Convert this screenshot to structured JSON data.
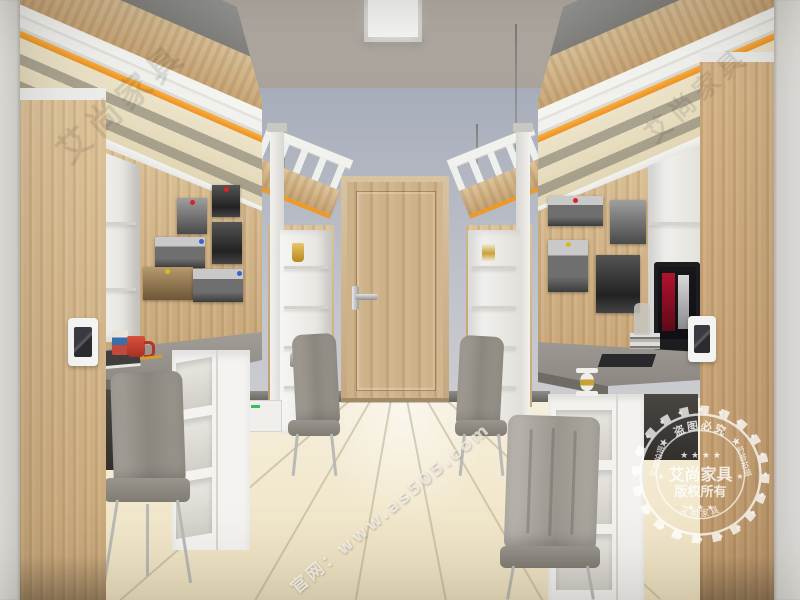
{
  "watermarks": {
    "brand": "艾尚家具",
    "site": "官网：www.as505.com",
    "stamp": {
      "top_arc": "★ 盗图必究 ★",
      "bottom_arc": "艾尚家具",
      "side_left": "实物拍摄",
      "side_right": "实物拍摄",
      "center_title": "艾尚家具",
      "center_subtitle": "版权所有",
      "stars_row_top": "★ ★ ★ ★",
      "stars_row_bottom": "★ ★ ★",
      "star_left": "★",
      "star_right": "★"
    }
  },
  "colors": {
    "accent_orange": "#f09a2c",
    "wall_blue_gray": "#b2b7c3",
    "ceiling_gray": "#b3aca4",
    "floor_cream": "#f2e9d2",
    "wood_light": "#d3b68c",
    "mug_red": "#c43b2e"
  },
  "scene_objects": [
    "dormitory-room",
    "loft-bed-left",
    "loft-bed-right",
    "wood-door",
    "ceiling-light",
    "study-desk-left",
    "study-desk-right",
    "monitor",
    "bookshelf",
    "desk-chair",
    "photo-wall",
    "wardrobe",
    "hourglass",
    "red-mug",
    "kettle",
    "trophy"
  ]
}
